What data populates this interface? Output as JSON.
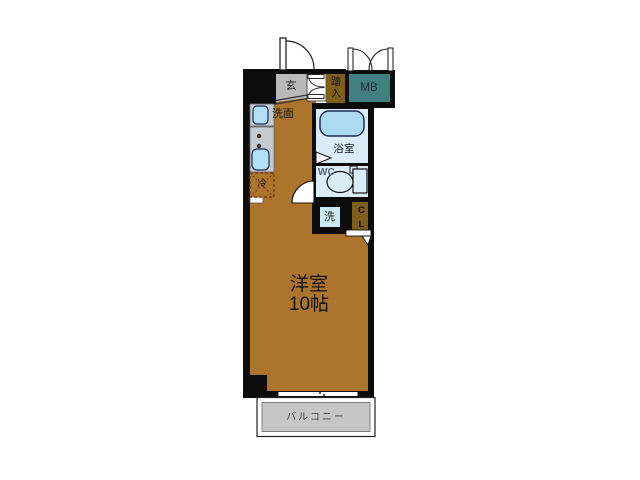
{
  "plan": {
    "title_hint": "apartment-floorplan",
    "entrance": {
      "genkan_label": "玄",
      "fumikomi_label": "踏入"
    },
    "meter_box": {
      "label": "MB"
    },
    "washstand": {
      "label": "洗面"
    },
    "refrigerator": {
      "label": "冷"
    },
    "bathroom": {
      "label": "浴室"
    },
    "toilet": {
      "label": "WC"
    },
    "laundry": {
      "label": "洗"
    },
    "closet": {
      "label": "CL"
    },
    "main_room": {
      "name": "洋室",
      "size": "10帖"
    },
    "balcony": {
      "label": "バルコニー"
    },
    "colors": {
      "floor_brown": "#ad742c",
      "dark_brown": "#7f5e1b",
      "meter_box_teal": "#41807f",
      "genkan_gray": "#b9b9b9",
      "bath_bg_blue": "#d9ecf7",
      "bathtub_blue": "#abdaf2",
      "fixture_gray": "#c3cad1",
      "laundry_blue": "#c9e9f4",
      "balcony_gray": "#c6c6c6",
      "wall_black": "#0c0c0c"
    }
  }
}
